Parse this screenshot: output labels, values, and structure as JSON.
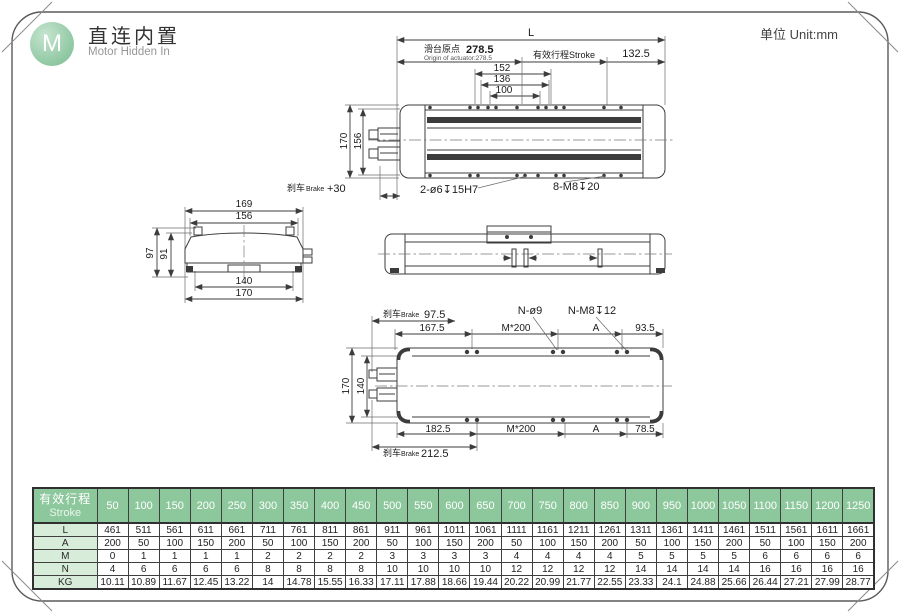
{
  "page": {
    "logo_letter": "M",
    "title_cn": "直连内置",
    "title_en": "Motor Hidden  In",
    "unit_label": "单位 Unit:mm"
  },
  "top_view": {
    "dim_L": "L",
    "origin_cn": "滑台原点",
    "origin_value": "278.5",
    "origin_en": "Origin of actuator:278.5",
    "stroke_label": "有效行程Stroke",
    "dim_132_5": "132.5",
    "dim_152": "152",
    "dim_136": "136",
    "dim_100": "100",
    "dim_170": "170",
    "dim_156": "156",
    "brake_cn": "刹车",
    "brake_en": "Brake",
    "brake_value": "+30",
    "callout_holes": "2-ø6↧15H7",
    "callout_threads": "8-M8↧20"
  },
  "end_view": {
    "dim_169": "169",
    "dim_156": "156",
    "dim_97": "97",
    "dim_91": "91",
    "dim_140": "140",
    "dim_170": "170"
  },
  "plan_view": {
    "brake_cn": "刹车",
    "brake_en": "Brake",
    "brake_value": "97.5",
    "dim_167_5": "167.5",
    "callout_holes": "N-ø9",
    "callout_threads": "N-M8↧12",
    "pitch_top": "M*200",
    "dim_A_top": "A",
    "dim_93_5": "93.5",
    "dim_170": "170",
    "dim_140": "140",
    "dim_182_5": "182.5",
    "pitch_bottom": "M*200",
    "dim_A_bottom": "A",
    "dim_78_5": "78.5",
    "brake2_cn": "刹车",
    "brake2_en": "Brake",
    "brake2_value": "212.5"
  },
  "table": {
    "header_cn": "有效行程",
    "header_en": "Stroke",
    "strokes": [
      50,
      100,
      150,
      200,
      250,
      300,
      350,
      400,
      450,
      500,
      550,
      600,
      650,
      700,
      750,
      800,
      850,
      900,
      950,
      1000,
      1050,
      1100,
      1150,
      1200,
      1250
    ],
    "rows": [
      {
        "label": "L",
        "values": [
          461,
          511,
          561,
          611,
          661,
          711,
          761,
          811,
          861,
          911,
          961,
          1011,
          1061,
          1111,
          1161,
          1211,
          1261,
          1311,
          1361,
          1411,
          1461,
          1511,
          1561,
          1611,
          1661
        ]
      },
      {
        "label": "A",
        "values": [
          200,
          50,
          100,
          150,
          200,
          50,
          100,
          150,
          200,
          50,
          100,
          150,
          200,
          50,
          100,
          150,
          200,
          50,
          100,
          150,
          200,
          50,
          100,
          150,
          200
        ]
      },
      {
        "label": "M",
        "values": [
          0,
          1,
          1,
          1,
          1,
          2,
          2,
          2,
          2,
          3,
          3,
          3,
          3,
          4,
          4,
          4,
          4,
          5,
          5,
          5,
          5,
          6,
          6,
          6,
          6
        ]
      },
      {
        "label": "N",
        "values": [
          4,
          6,
          6,
          6,
          6,
          8,
          8,
          8,
          8,
          10,
          10,
          10,
          10,
          12,
          12,
          12,
          12,
          14,
          14,
          14,
          14,
          16,
          16,
          16,
          16
        ]
      },
      {
        "label": "KG",
        "values": [
          10.11,
          10.89,
          11.67,
          12.45,
          13.22,
          14,
          14.78,
          15.55,
          16.33,
          17.11,
          17.88,
          18.66,
          19.44,
          20.22,
          20.99,
          21.77,
          22.55,
          23.33,
          24.1,
          24.88,
          25.66,
          26.44,
          27.21,
          27.99,
          28.77
        ]
      }
    ]
  }
}
